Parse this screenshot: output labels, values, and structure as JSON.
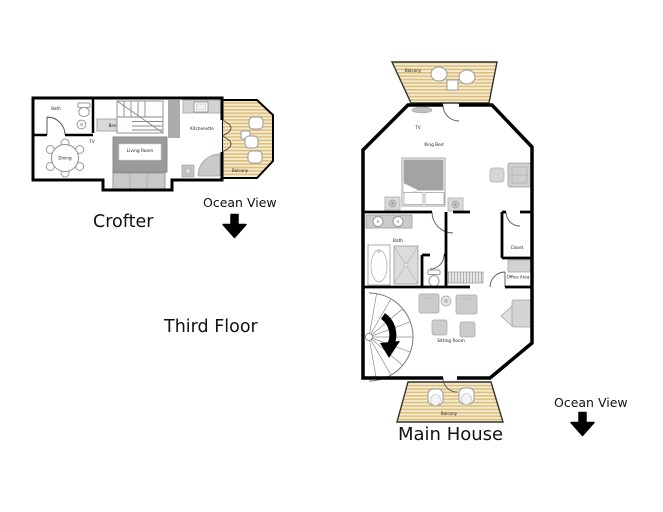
{
  "title_labels": {
    "crofter": "Crofter",
    "third_floor": "Third Floor",
    "main_house": "Main House",
    "ocean_view_left": "Ocean View",
    "ocean_view_right": "Ocean View"
  },
  "crofter_plan": {
    "rooms": {
      "bath": "Bath",
      "bench": "Bench",
      "tv": "TV",
      "dining": "Dining",
      "living_room": "Living Room",
      "kitchenette": "Kitchenette",
      "balcony": "Balcony"
    }
  },
  "main_house_plan": {
    "rooms": {
      "balcony_top": "Balcony",
      "tv": "TV",
      "king_bed": "King Bed",
      "bath": "Bath",
      "closet": "Closet",
      "office_area": "Office Area",
      "sitting_room": "Sitting Room",
      "balcony_bottom": "Balcony"
    }
  },
  "colors": {
    "wall": "#000000",
    "deck_light": "#f5ecd2",
    "deck_dark": "#ddbf7d",
    "furniture_light": "#d6d6d6",
    "furniture_mid": "#c4c4c4",
    "furniture_dark": "#9a9a9a",
    "text": "#1a1a1a"
  }
}
